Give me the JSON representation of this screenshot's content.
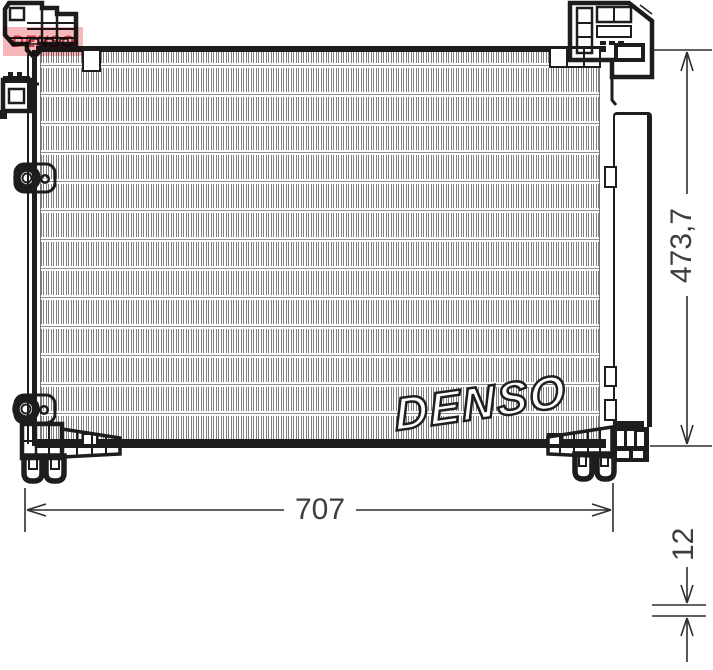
{
  "watermark": {
    "brand": "DENSO"
  },
  "logo": {
    "brand": "DENSO"
  },
  "dimensions": {
    "width": "707",
    "height": "473,7",
    "depth": "12"
  },
  "colors": {
    "line": "#1d1d1d",
    "hatch": "#808080",
    "dimension_text": "#3d3d3d",
    "logo_background": "#f4a0a6",
    "logo_text": "#cf3a44",
    "watermark_fill": "#ffffff",
    "watermark_outline": "#1f1f1f"
  }
}
